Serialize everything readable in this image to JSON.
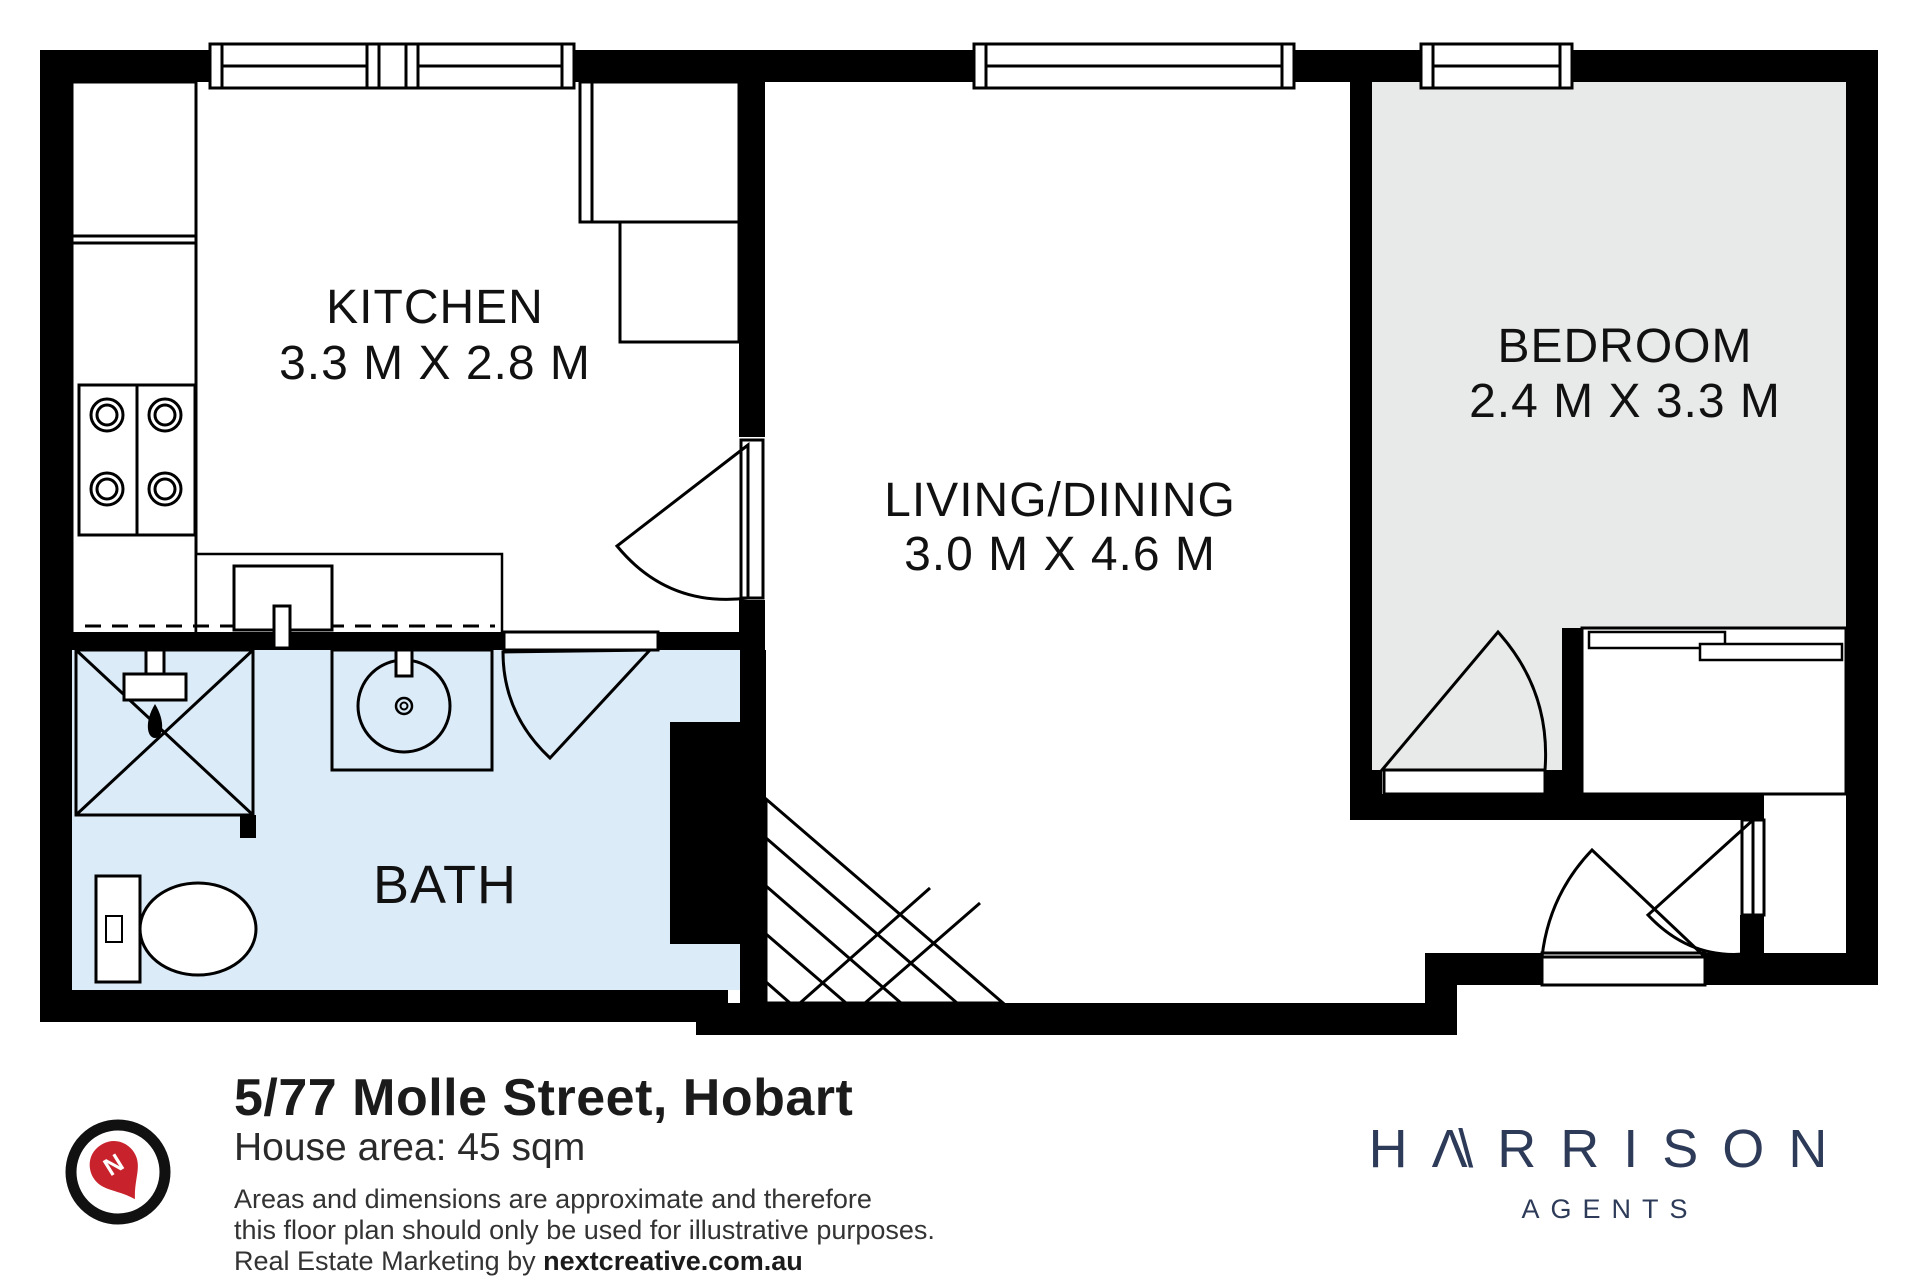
{
  "rooms": {
    "kitchen": {
      "name": "KITCHEN",
      "dims": "3.3 M X 2.8 M"
    },
    "living": {
      "name": "LIVING/DINING",
      "dims": "3.0 M X 4.6 M"
    },
    "bedroom": {
      "name": "BEDROOM",
      "dims": "2.4 M X 3.3 M"
    },
    "bath": {
      "name": "BATH"
    }
  },
  "footer": {
    "address": "5/77 Molle Street, Hobart",
    "house_area": "House area: 45 sqm",
    "disclaimer_line1": "Areas and dimensions are approximate and therefore",
    "disclaimer_line2": "this floor plan should only be used for illustrative purposes.",
    "marketing_prefix": "Real Estate Marketing by ",
    "marketing_brand": "nextcreative.com.au"
  },
  "compass": {
    "label": "N"
  },
  "logo": {
    "part1": "H",
    "a_peak": "Λ",
    "a_slash": "\\",
    "part2": "RRISON",
    "tagline": "AGENTS"
  },
  "colors": {
    "bath_floor": "#dcebf8",
    "bedroom_floor": "#e8e9e9",
    "wall_black": "#000000",
    "logo_navy": "#2d3b59",
    "compass_red": "#c8232c"
  }
}
